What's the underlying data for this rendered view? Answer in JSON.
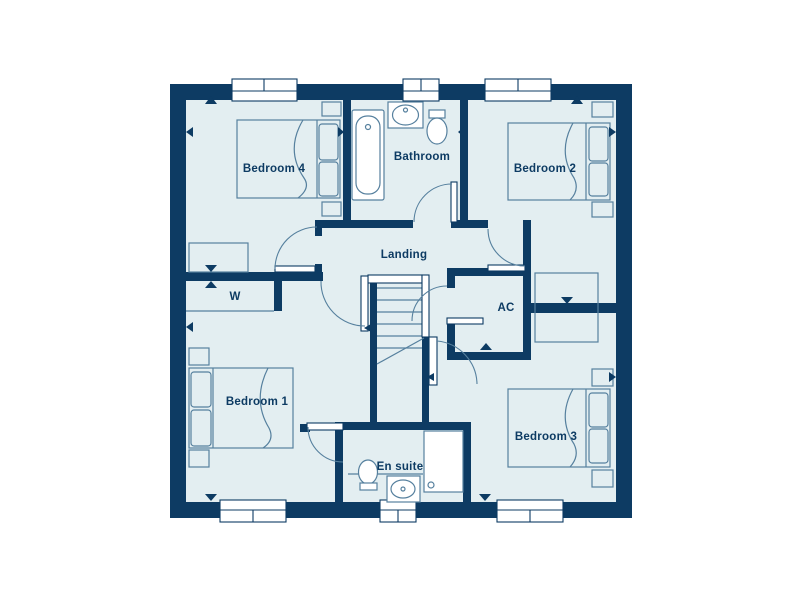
{
  "floor_plan": {
    "rooms": {
      "bedroom_4": "Bedroom 4",
      "bathroom": "Bathroom",
      "bedroom_2": "Bedroom 2",
      "landing": "Landing",
      "wardrobe": "W",
      "airing_cupboard": "AC",
      "bedroom_1": "Bedroom 1",
      "bedroom_3": "Bedroom 3",
      "en_suite": "En suite"
    },
    "colors": {
      "wall": "#0d3b63",
      "floor": "#e3eef1",
      "furniture_line": "#56809e",
      "label_text": "#0d3b63",
      "background": "#ffffff"
    }
  }
}
